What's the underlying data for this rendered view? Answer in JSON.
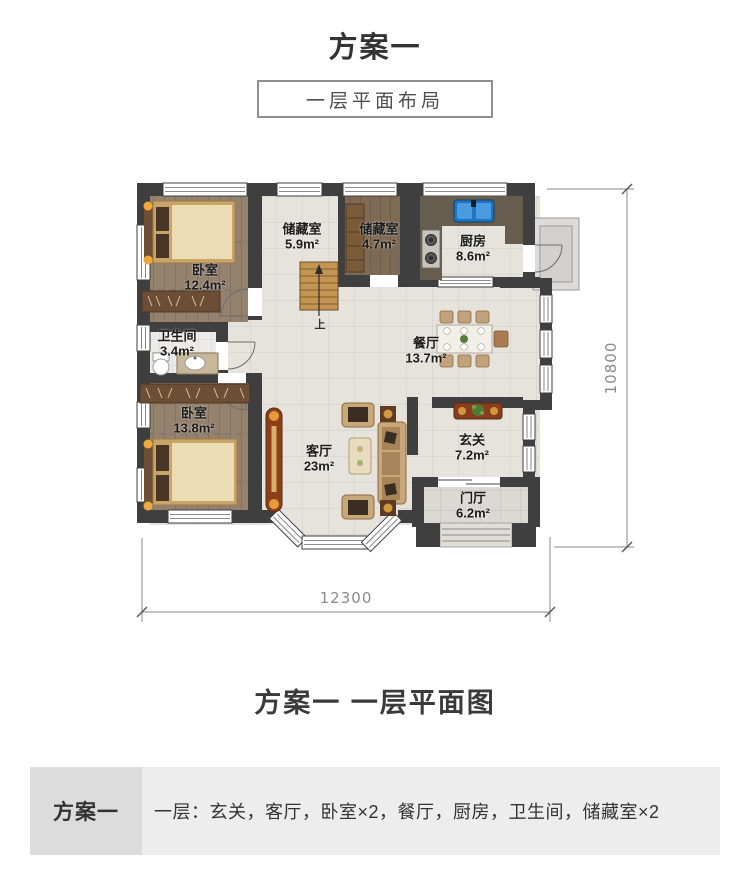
{
  "page": {
    "title": "方案一",
    "subtitle": "一层平面布局",
    "caption": "方案一 一层平面图"
  },
  "floorplan": {
    "rooms": [
      {
        "name": "卧室",
        "area": "12.4m²"
      },
      {
        "name": "储藏室",
        "area": "5.9m²"
      },
      {
        "name": "储藏室",
        "area": "4.7m²"
      },
      {
        "name": "厨房",
        "area": "8.6m²"
      },
      {
        "name": "卫生间",
        "area": "3.4m²"
      },
      {
        "name": "餐厅",
        "area": "13.7m²"
      },
      {
        "name": "卧室",
        "area": "13.8m²"
      },
      {
        "name": "客厅",
        "area": "23m²"
      },
      {
        "name": "玄关",
        "area": "7.2m²"
      },
      {
        "name": "门厅",
        "area": "6.2m²"
      }
    ],
    "stair_label": "上",
    "dim_width": "12300",
    "dim_height": "10800"
  },
  "summary": {
    "plan": "方案一",
    "rooms_list": "一层：玄关，客厅，卧室×2，餐厅，厨房，卫生间，储藏室×2"
  }
}
